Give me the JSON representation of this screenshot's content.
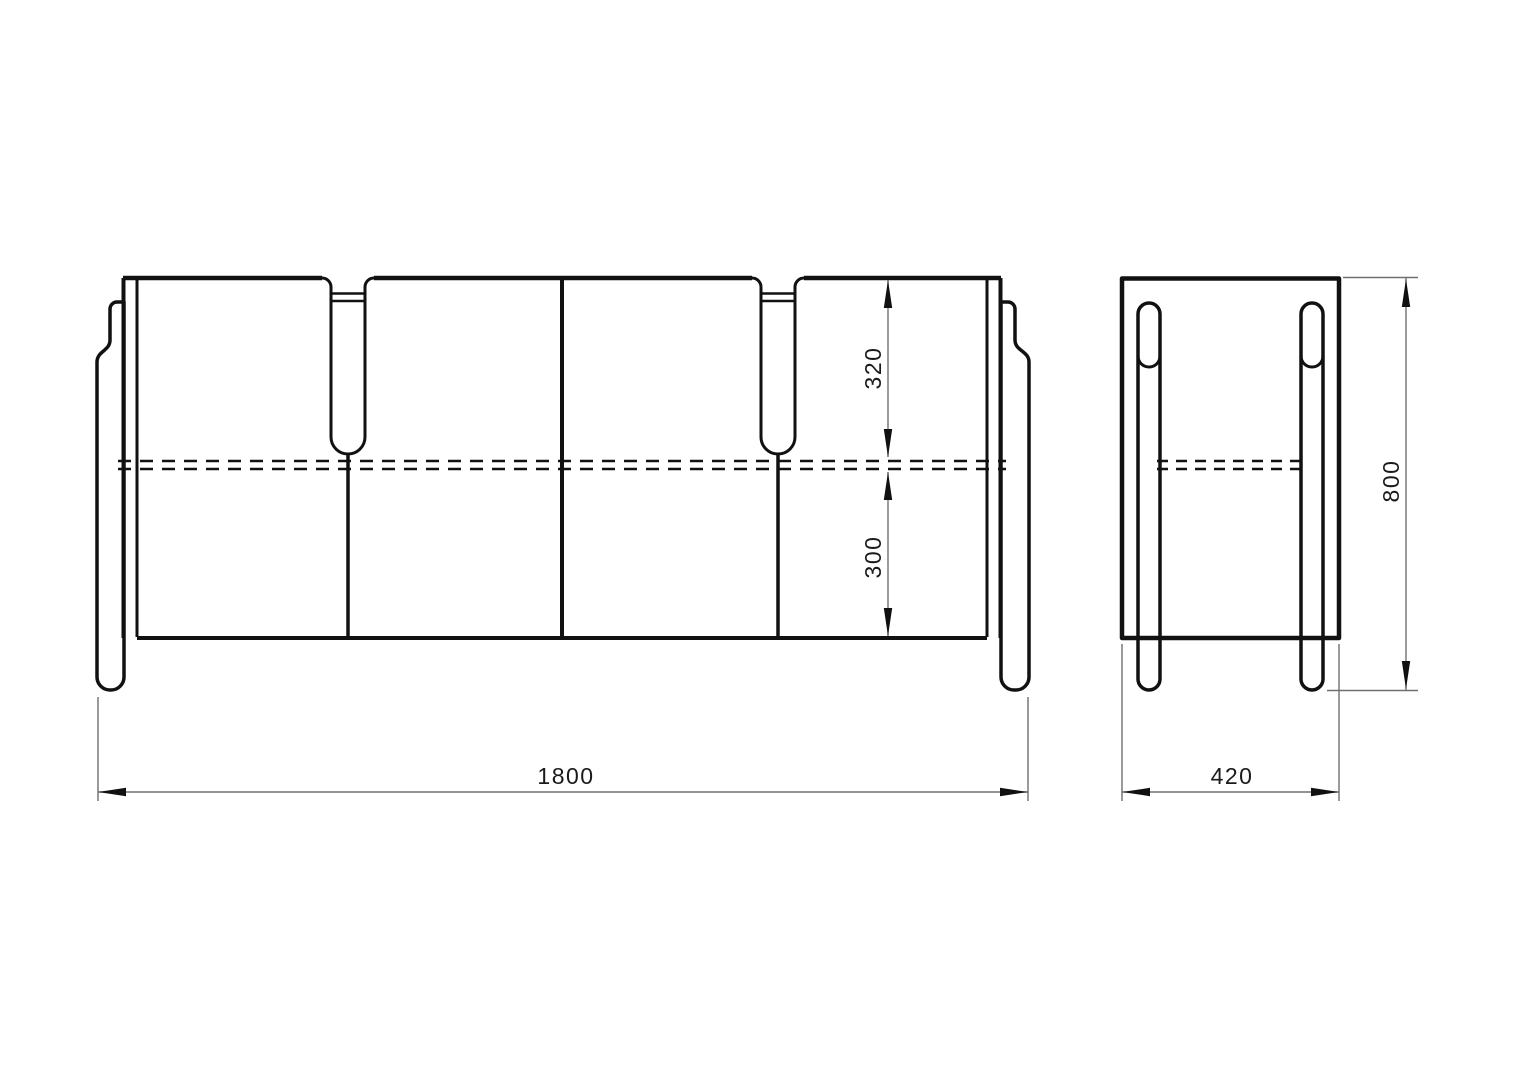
{
  "dims": {
    "width": "1800",
    "depth": "420",
    "height": "800",
    "upper": "320",
    "lower": "300"
  },
  "colors": {
    "outline": "#111111",
    "dim_line": "#707070",
    "text": "#1a1a1a",
    "background": "#ffffff"
  }
}
